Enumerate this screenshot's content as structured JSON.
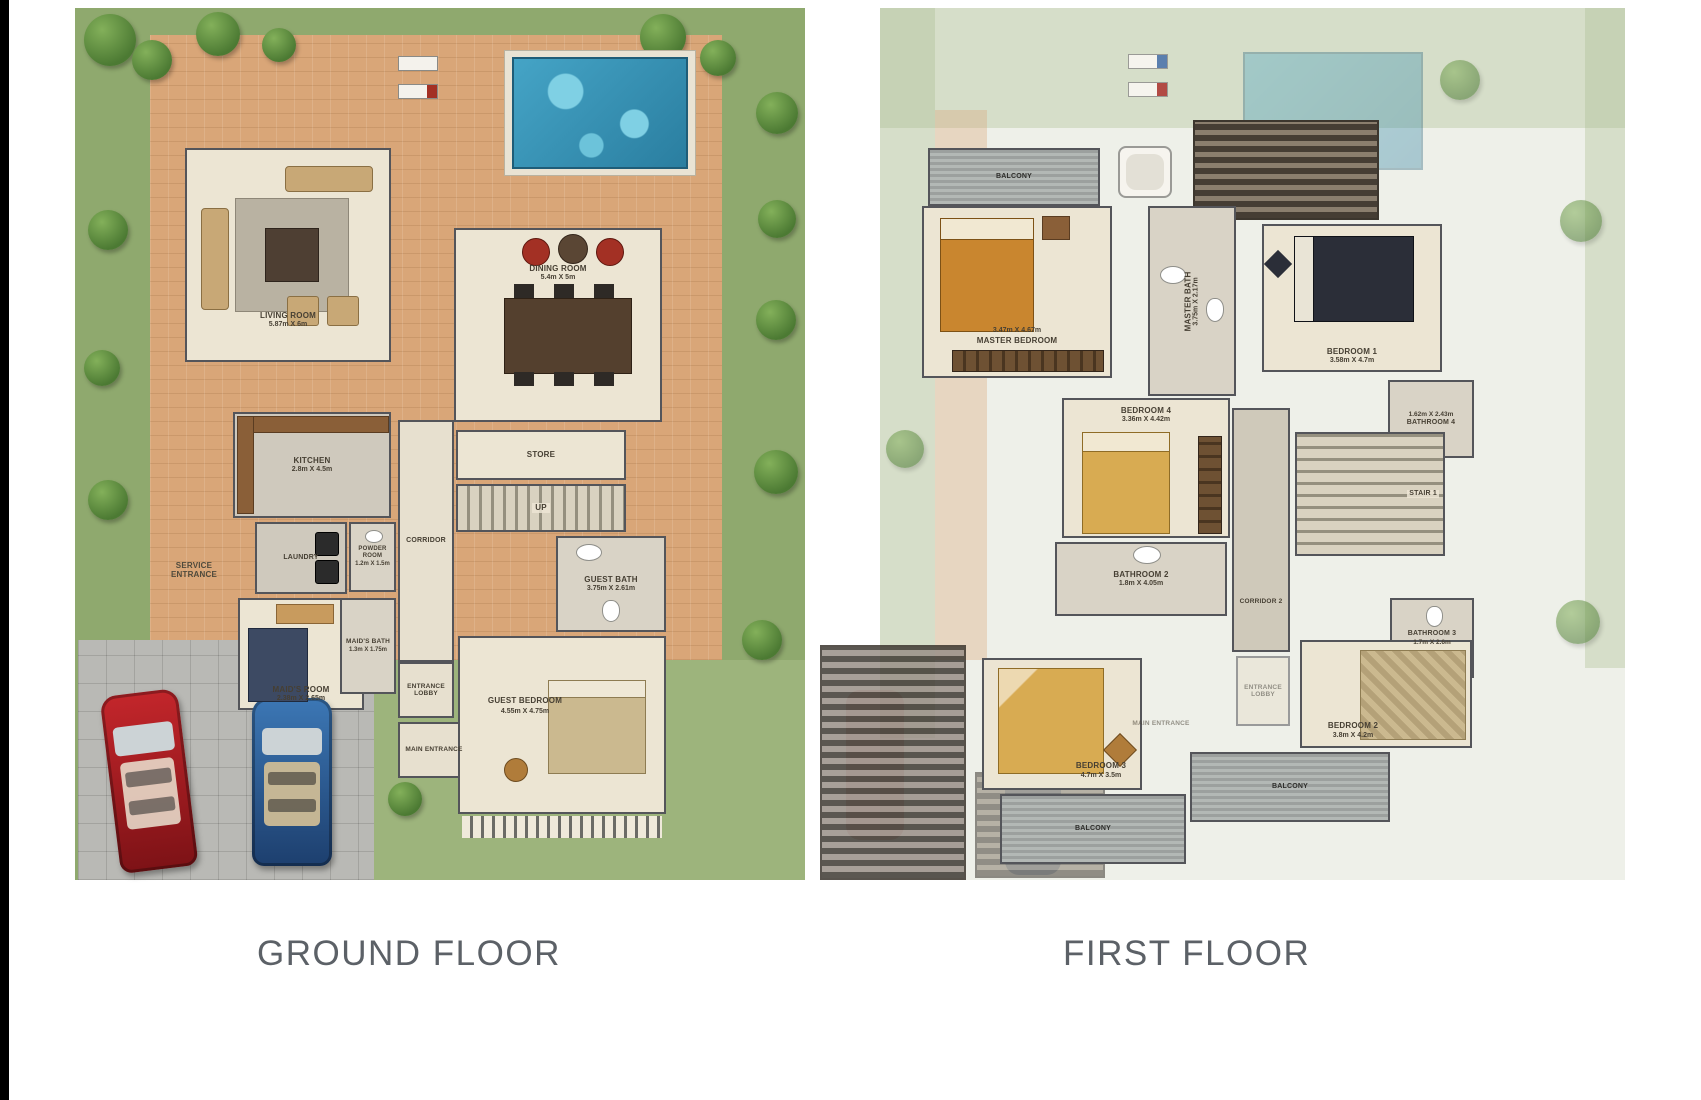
{
  "titles": {
    "ground": "GROUND FLOOR",
    "first": "FIRST FLOOR"
  },
  "ground": {
    "rooms": [
      {
        "name": "LIVING ROOM",
        "dims": "5.87m X 6m"
      },
      {
        "name": "DINING ROOM",
        "dims": "5.4m X 5m"
      },
      {
        "name": "KITCHEN",
        "dims": "2.8m X 4.5m"
      },
      {
        "name": "STORE",
        "dims": ""
      },
      {
        "name": "UP",
        "dims": ""
      },
      {
        "name": "CORRIDOR",
        "dims": ""
      },
      {
        "name": "LAUNDRY",
        "dims": ""
      },
      {
        "name": "POWDER ROOM",
        "dims": "1.2m X 1.5m"
      },
      {
        "name": "SERVICE ENTRANCE",
        "dims": ""
      },
      {
        "name": "MAID'S ROOM",
        "dims": "2.38m X 2.65m"
      },
      {
        "name": "MAID'S BATH",
        "dims": "1.3m X 1.75m"
      },
      {
        "name": "ENTRANCE LOBBY",
        "dims": ""
      },
      {
        "name": "MAIN ENTRANCE",
        "dims": ""
      },
      {
        "name": "GUEST BATH",
        "dims": "3.75m X 2.61m"
      },
      {
        "name": "GUEST BEDROOM",
        "dims": "4.55m X 4.75m"
      }
    ]
  },
  "first": {
    "rooms": [
      {
        "name": "BALCONY",
        "dims": ""
      },
      {
        "name": "MASTER BEDROOM",
        "dims": "3.47m X 4.67m"
      },
      {
        "name": "MASTER BATH",
        "dims": "3.75m X 2.17m"
      },
      {
        "name": "BEDROOM 1",
        "dims": "3.58m X 4.7m"
      },
      {
        "name": "BATHROOM 4",
        "dims": "1.62m X 2.43m"
      },
      {
        "name": "BEDROOM 4",
        "dims": "3.36m X 4.42m"
      },
      {
        "name": "BATHROOM 2",
        "dims": "1.8m X 4.05m"
      },
      {
        "name": "CORRIDOR 2",
        "dims": ""
      },
      {
        "name": "STAIR 1",
        "dims": ""
      },
      {
        "name": "BATHROOM 3",
        "dims": "1.7m X 2.6m"
      },
      {
        "name": "BEDROOM 2",
        "dims": "3.8m X 4.2m"
      },
      {
        "name": "BEDROOM 3",
        "dims": "4.7m X 3.5m"
      },
      {
        "name": "BALCONY",
        "dims": ""
      },
      {
        "name": "BALCONY",
        "dims": ""
      },
      {
        "name": "ENTRANCE LOBBY",
        "dims": ""
      },
      {
        "name": "MAIN ENTRANCE",
        "dims": ""
      }
    ]
  },
  "colors": {
    "garden": "#8fa96e",
    "paving": "#d9a678",
    "pool": "#45a4c6",
    "wall": "#54555a",
    "room_fill": "#ece5d3",
    "title_text": "#5c6167",
    "driveway": "#b9b9b5",
    "car_red": "#a41e22",
    "car_blue": "#2b5f9e"
  }
}
